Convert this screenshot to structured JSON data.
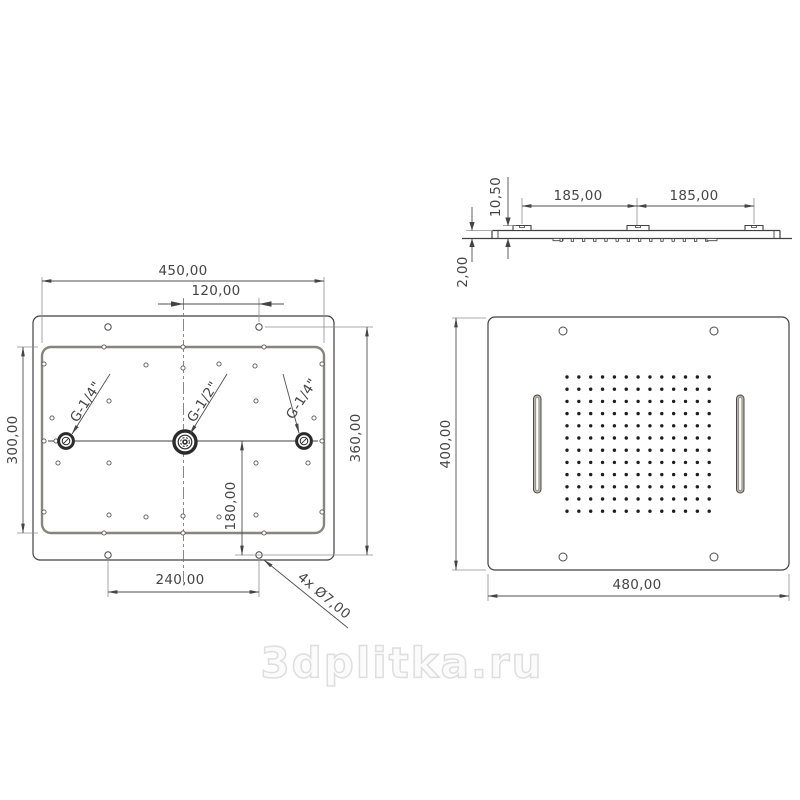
{
  "watermark": {
    "text": "3dplitka.ru"
  },
  "drawing_title": "ceiling shower head technical drawing",
  "back_view": {
    "name": "back (mounting) view",
    "dims": {
      "plate_width": "450,00",
      "inlet_offset": "120,00",
      "plate_height": "300,00",
      "hole_span_v": "360,00",
      "center_offset": "180,00",
      "hole_span_h": "240,00",
      "hole_callout": "4x Ø7,00"
    },
    "fittings": [
      {
        "label": "G-1/4\""
      },
      {
        "label": "G-1/2\""
      },
      {
        "label": "G-1/4\""
      }
    ],
    "mount_hole_count": 4,
    "small_holes": [
      [
        104,
        347
      ],
      [
        183,
        347
      ],
      [
        264,
        347
      ],
      [
        104,
        533
      ],
      [
        183,
        533
      ],
      [
        264,
        533
      ],
      [
        44,
        364
      ],
      [
        44,
        441
      ],
      [
        44,
        512
      ],
      [
        322,
        364
      ],
      [
        322,
        441
      ],
      [
        322,
        512
      ],
      [
        56,
        441
      ],
      [
        310,
        441
      ],
      [
        52,
        418
      ],
      [
        314,
        418
      ],
      [
        58,
        463
      ],
      [
        308,
        463
      ],
      [
        146,
        365
      ],
      [
        219,
        364
      ],
      [
        255,
        366
      ],
      [
        183,
        368
      ],
      [
        109,
        401
      ],
      [
        256,
        401
      ],
      [
        109,
        463
      ],
      [
        256,
        463
      ],
      [
        109,
        515
      ],
      [
        146,
        517
      ],
      [
        183,
        516
      ],
      [
        219,
        517
      ],
      [
        256,
        515
      ]
    ]
  },
  "side_view": {
    "name": "side profile view",
    "dims": {
      "spacing_left": "185,00",
      "spacing_right": "185,00",
      "connector_height": "10,50",
      "plate_thickness": "2,00"
    },
    "connector_count": 3,
    "nozzle_ticks": {
      "count": 14,
      "x0": 560,
      "dx": 11.2,
      "y": 238.5
    }
  },
  "front_view": {
    "name": "front (spray face) view",
    "dims": {
      "height": "400,00",
      "width": "480,00"
    },
    "mount_hole_count": 4,
    "slot_count": 2,
    "nozzle_grid": {
      "cols": 13,
      "rows": 12,
      "x0": 567,
      "y0": 377,
      "dx": 11.85,
      "dy": 12.2
    }
  },
  "colors": {
    "line": "#414141",
    "plate_edge": "#87857d",
    "slot_fill": "#b6b2a5",
    "dot": "#1e1e1e",
    "watermark_stroke": "#dedede"
  }
}
